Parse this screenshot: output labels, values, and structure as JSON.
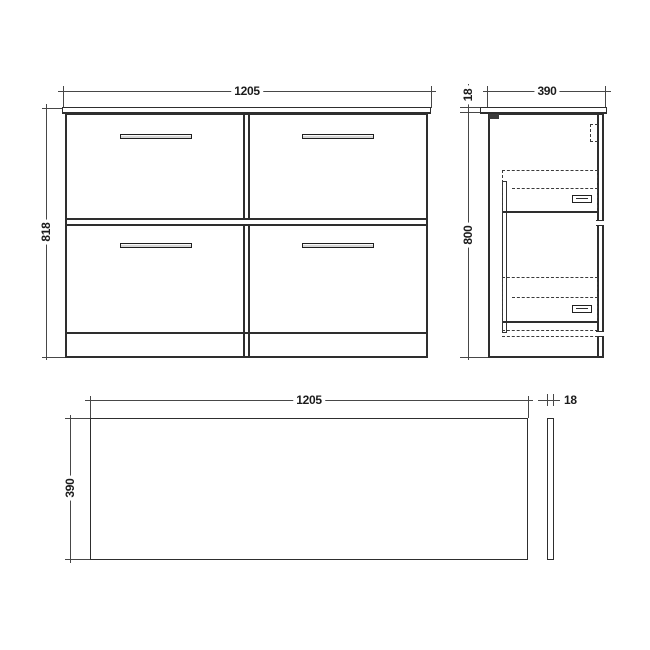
{
  "drawing": {
    "front_view": {
      "width": "1205",
      "height": "818"
    },
    "side_view": {
      "depth": "390",
      "worktop_thickness": "18",
      "cabinet_height": "800"
    },
    "plan_view": {
      "width": "1205",
      "depth": "390",
      "end_panel_thickness": "18"
    }
  },
  "colors": {
    "line": "#2e2e2e",
    "dimension": "#474747",
    "background": "#ffffff",
    "handle_fill": "#d6d6d6",
    "bracket_fill": "#3a3a3a"
  }
}
